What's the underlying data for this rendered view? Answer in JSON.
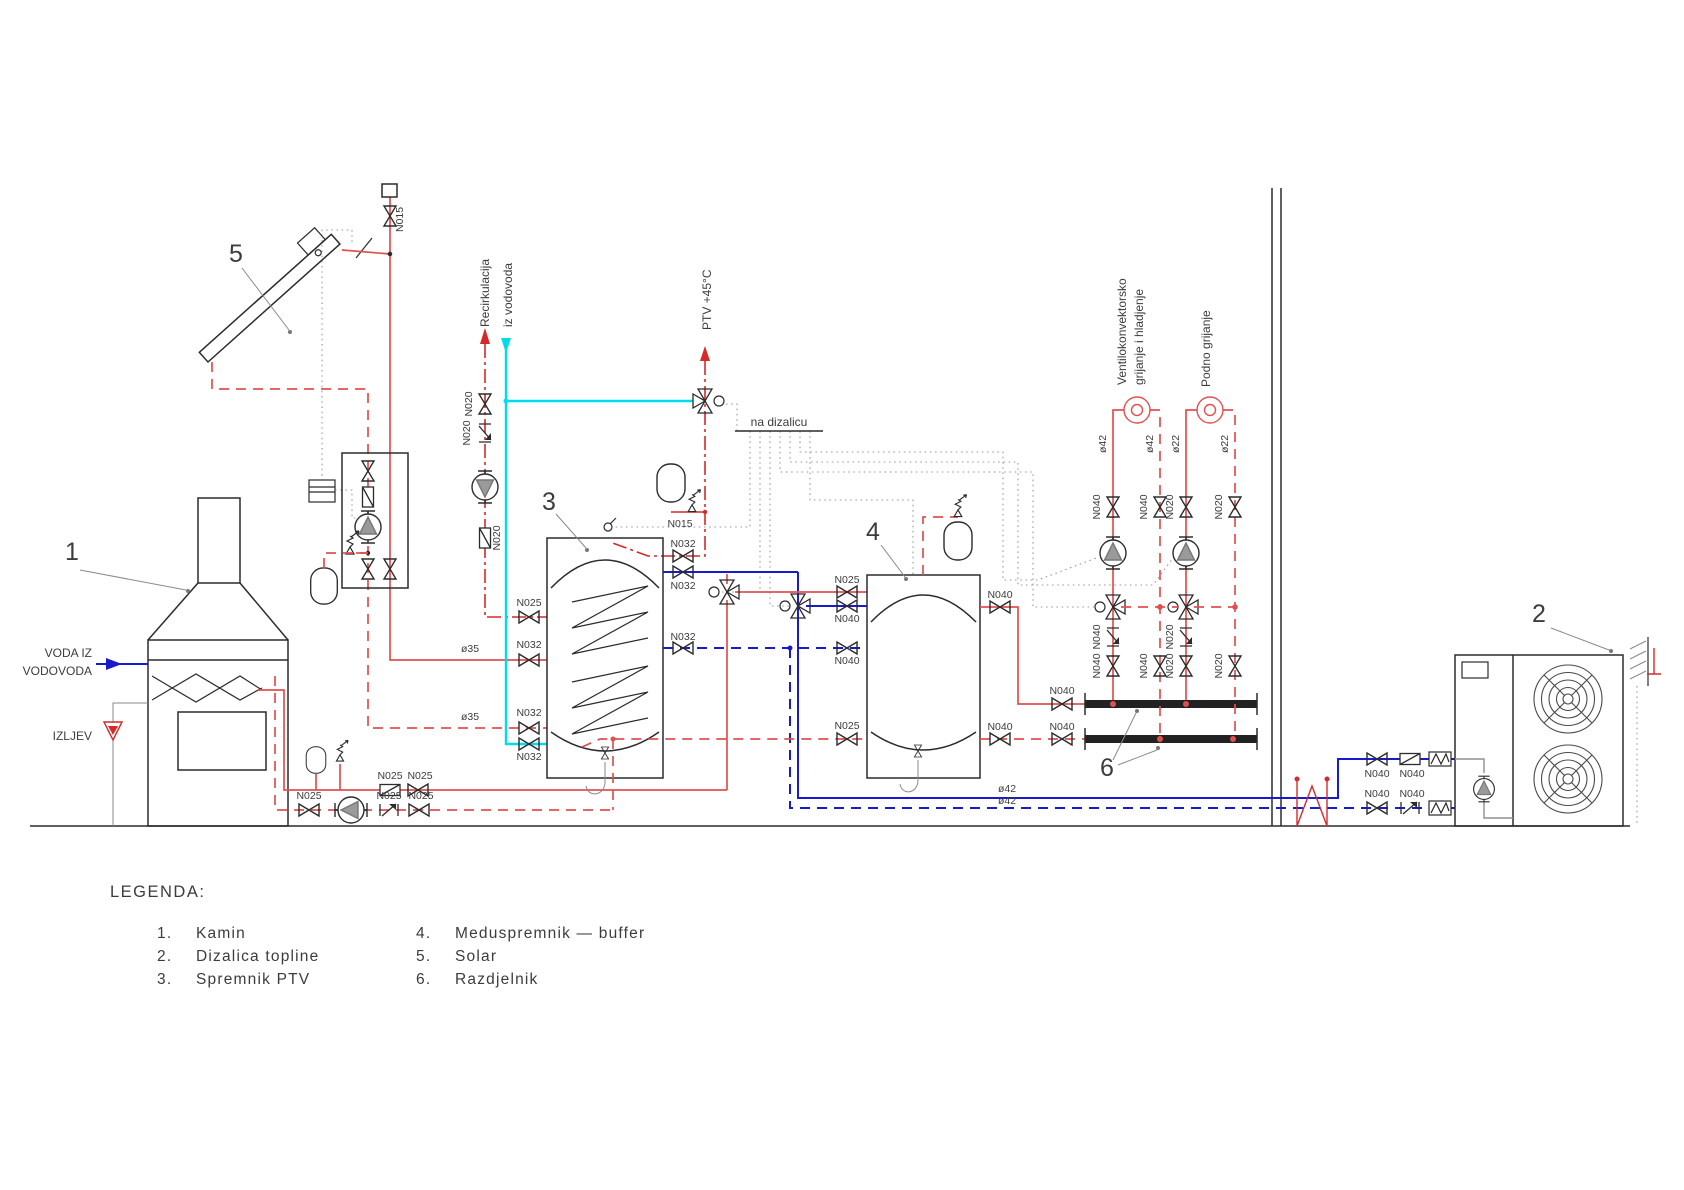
{
  "diagram": {
    "legend": {
      "title": "LEGENDA:",
      "items": [
        {
          "num": "1.",
          "label": "Kamin"
        },
        {
          "num": "2.",
          "label": "Dizalica topline"
        },
        {
          "num": "3.",
          "label": "Spremnik PTV"
        },
        {
          "num": "4.",
          "label": "Meduspremnik — buffer"
        },
        {
          "num": "5.",
          "label": "Solar"
        },
        {
          "num": "6.",
          "label": "Razdjelnik"
        }
      ]
    },
    "component_numbers": {
      "kamin": "1",
      "dizalica_topline": "2",
      "spremnik_ptv": "3",
      "meduspremnik": "4",
      "solar": "5",
      "razdjelnik": "6"
    },
    "flow_labels": {
      "recirkulacija": "Recirkulacija",
      "iz_vodovoda": "iz vodovoda",
      "ptv": "PTV +45°C",
      "na_dizalicu": "na dizalicu",
      "voda_iz_1": "VODA IZ",
      "voda_iz_2": "VODOVODA",
      "izljev": "IZLJEV",
      "fan_coil_1": "Ventilokonvektorsko",
      "fan_coil_2": "grijanje i hladjenje",
      "podno": "Podno grijanje"
    },
    "sizes": {
      "n015": "N015",
      "n020": "N020",
      "n025": "N025",
      "n032": "N032",
      "n040": "N040",
      "d35": "ø35",
      "d42": "ø42",
      "d22": "ø22"
    },
    "colors": {
      "hot": "#e05050",
      "hot_dark": "#d42a2a",
      "cold": "#1a1acd",
      "fresh": "#00dbee",
      "text": "#3c3c3c"
    }
  }
}
